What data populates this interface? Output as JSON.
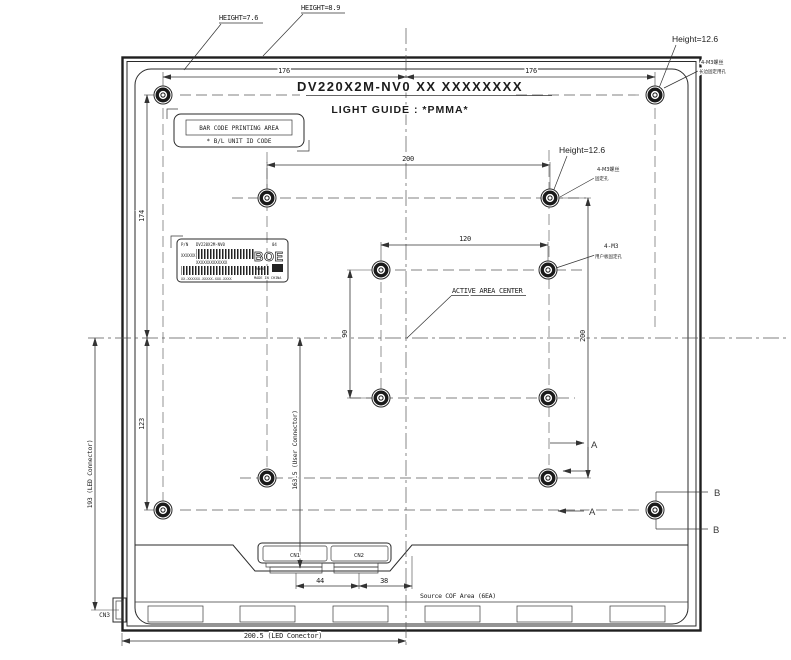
{
  "title": {
    "part_number": "DV220X2M-NV0  XX  XXXXXXXX",
    "material_line": "LIGHT GUIDE : *PMMA*"
  },
  "callouts": {
    "height_left": "HEIGHT=7.6",
    "height_top": "HEIGHT=8.9",
    "height_corner": "Height=12.6",
    "height_mid": "Height=12.6",
    "corner_hole_l1": "4-M3螺丝",
    "corner_hole_l2": "长边固定用孔",
    "mid_hole_l1": "4-M3螺丝",
    "mid_hole_l2": "固定孔",
    "user_hole_l1": "4-M3",
    "user_hole_l2": "用户板固定孔",
    "active_area_center": "ACTIVE AREA CENTER",
    "source_cof_area": "Source COF Area (6EA)"
  },
  "barcode_area": {
    "line1": "BAR CODE PRINTING AREA",
    "line2": "* B/L UNIT ID CODE"
  },
  "sticker": {
    "pn_label": "P/N",
    "part_number": "DV220X2M-NV0",
    "rev": "04",
    "brand": "BOE",
    "left_code": "XXXXXX",
    "mid_code": "XXXXXXXXXXXXX",
    "serial": "XX-XXXXXX-XXXXX-XXX-XXXX",
    "cert": "RoHS",
    "made_in": "MADE IN CHINA"
  },
  "connectors": {
    "cn1": "CN1",
    "cn2": "CN2",
    "cn3": "CN3"
  },
  "sections": {
    "a_top": "A",
    "a_bottom": "A",
    "b_top": "B",
    "b_bottom": "B"
  },
  "dimensions": {
    "w_left": "176",
    "w_right": "176",
    "mount_w": "200",
    "inner_w": "120",
    "inner_h": "90",
    "mount_h": "200",
    "top_to_center": "174",
    "center_to_bottom": "123",
    "led_connector_v": "193 (LED Connector)",
    "user_connector_v": "163.5 (User Connector)",
    "cn_pitch": "44",
    "cn_to_center": "38",
    "led_connector_h": "200.5 (LED Conector)"
  }
}
